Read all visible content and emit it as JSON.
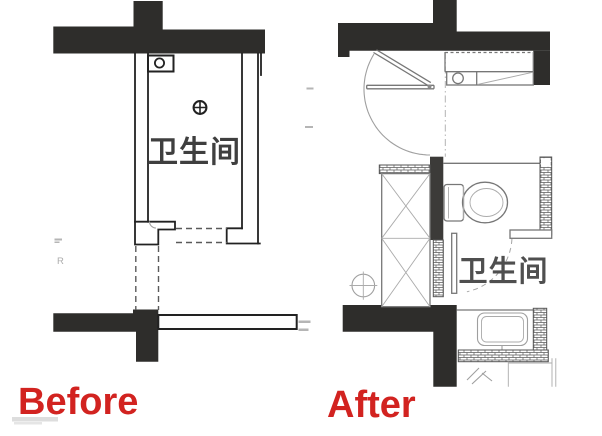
{
  "canvas": {
    "width": 602,
    "height": 436,
    "background": "#ffffff"
  },
  "plans": [
    {
      "id": "before",
      "label": "Before",
      "room_label": "卫生间"
    },
    {
      "id": "after",
      "label": "After",
      "room_label": "卫生间"
    }
  ],
  "colors": {
    "wall": "#2e2d2b",
    "divider_wall": "#3c3b39",
    "line_dark": "#222222",
    "line_mid": "#777777",
    "line_light": "#9f9f9f",
    "label_red": "#d22320",
    "room_text_before": "#3f3f3f",
    "room_text_after": "#4f4f4f"
  },
  "artifacts": {
    "letter": "R"
  },
  "icons": {
    "floor_drain": "floor-drain-icon",
    "pipe_riser": "pipe-riser-icon",
    "axis_marker": "axis-marker-icon",
    "toilet": "toilet-fixture",
    "washbasin": "washbasin-fixture",
    "faucet": "faucet-icon",
    "door_swing": "door-swing-arc"
  }
}
